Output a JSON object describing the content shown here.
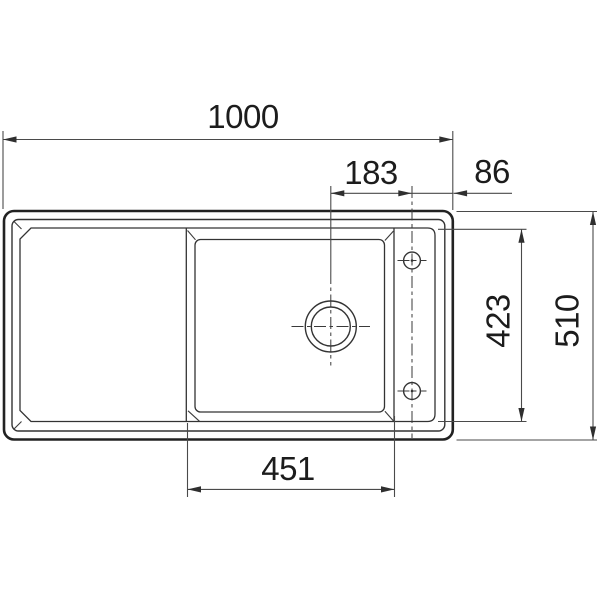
{
  "colors": {
    "background": "#ffffff",
    "main_line": "#222222",
    "dimension_line": "#4a4a4a",
    "label_text": "#1c1c1c"
  },
  "dimensions": {
    "overall_width": "1000",
    "drain_center_to_tap_center": "183",
    "tap_center_to_right_edge": "86",
    "basin_front_to_back": "423",
    "overall_depth": "510",
    "basin_width": "451"
  }
}
